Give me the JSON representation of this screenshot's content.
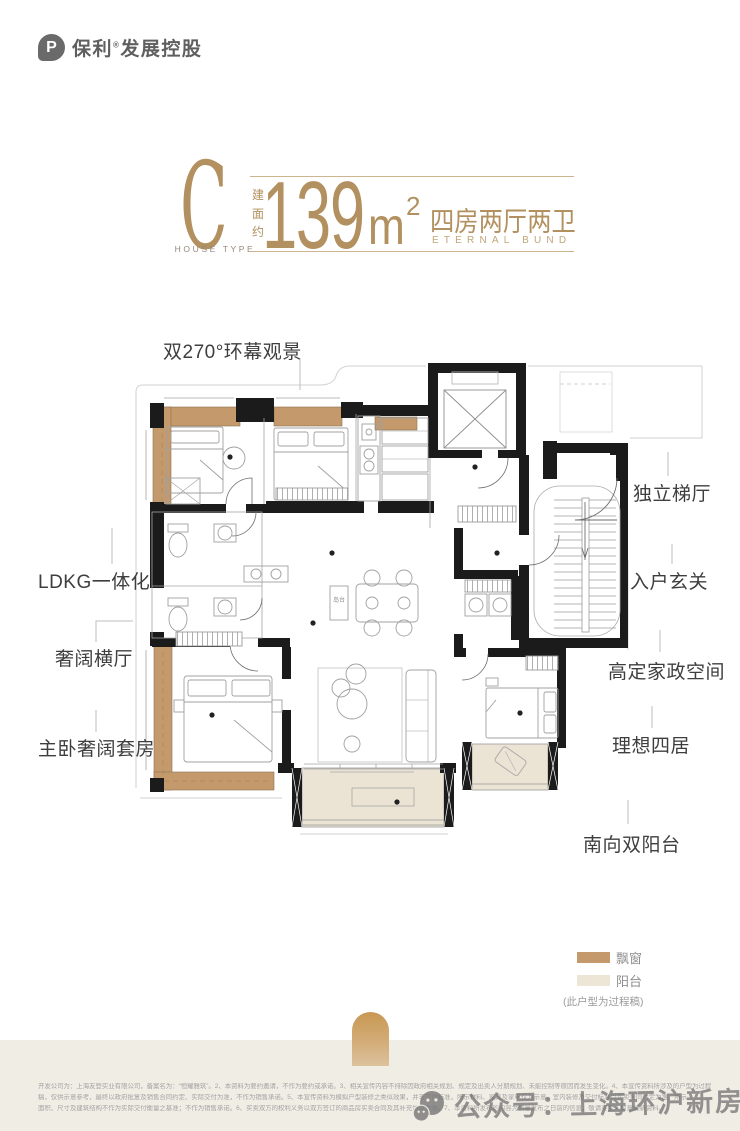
{
  "brand": {
    "name": "保利",
    "registered": "®",
    "suffix": "发展控股"
  },
  "title": {
    "house_type_letter": "C",
    "house_type_caption": "HOUSE TYPE",
    "area_label": "建面约",
    "area_number": "139",
    "area_unit": "m",
    "area_exponent": "2",
    "layout_text": "四房两厅两卫",
    "layout_subtitle": "ETERNAL BUND"
  },
  "plan_labels": {
    "panorama": "双270°环幕观景",
    "ldkg": "LDKG一体化",
    "hall": "奢阔横厅",
    "master": "主卧奢阔套房",
    "stair": "独立梯厅",
    "foyer": "入户玄关",
    "housework": "高定家政空间",
    "four_rooms": "理想四居",
    "south_balcony": "南向双阳台",
    "island": "岛台"
  },
  "legend": {
    "bay_window_label": "飘窗",
    "bay_window_color": "#C49A6C",
    "balcony_label": "阳台",
    "balcony_color": "#EDE6D6",
    "note": "(此户型为过程稿)"
  },
  "watermark": {
    "text": "公众号：上海环沪新房最全线"
  },
  "disclaimer": {
    "line1": "开发公司为：上海友登实业有限公司，备案名为：“恒耀雅筑”。2、本资料为要约邀请，不作为要约或承诺。3、相关宣传内容不排除因政府相关规划、规定及出卖人分期规划、未能控制等原因而发生变化。4、本宣传资料所涉及的户型为过程",
    "line2": "稿，仅供示意参考，最终以政府批复及销售合同约定、实际交付为准，不作为销售承诺。5、本宣传资料为模拟户型装修之类似效果，并非交付标准，所示材料、家具及家电仅为示意，室内装修及交付标准以买卖合同约定为准。所示",
    "line3": "面积、尺寸及建筑结构不作为实际交付衡量之基准；不作为销售承诺。6、买卖双方的权利义务以双方签订的商品房买卖合同及其补充协议为准。7、本资料所发布的内容为信息发布之日前的信息，敬请买受人留意最新资料。"
  },
  "colors": {
    "gold": "#B2905F",
    "wall": "#1B1B1B",
    "bay_window": "#C49A6C",
    "balcony_fill": "#EBE4D4",
    "footer_bg": "#F0EDE5"
  }
}
